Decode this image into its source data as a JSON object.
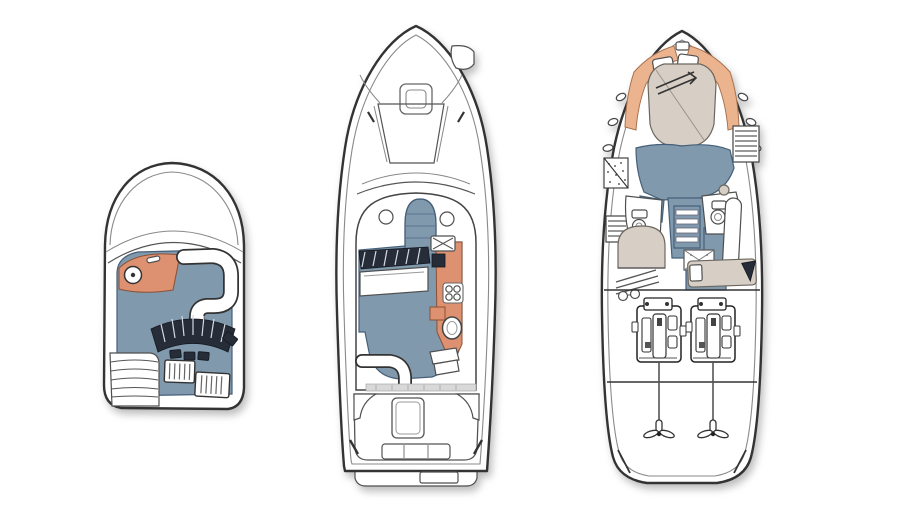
{
  "canvas": {
    "width": 900,
    "height": 506,
    "background": "#ffffff"
  },
  "colors": {
    "outline": "#333333",
    "outline_soft": "#8a8a8a",
    "deck_blue": "#8099ad",
    "deck_blue_dark": "#46607a",
    "helm_orange": "#dd9170",
    "helm_orange_light": "#ecb48e",
    "bed_beige": "#d7cfc5",
    "hatch_dark": "#262c38",
    "shadow": "rgba(70,70,70,0.35)"
  },
  "views": [
    {
      "id": "flybridge-plan",
      "position": "left",
      "features": [
        "helm-console",
        "steering-wheel",
        "wraparound-settee",
        "sunpad-seating",
        "deck-hatch-fore",
        "deck-hatch-aft",
        "ladder-steps"
      ]
    },
    {
      "id": "main-deck-plan",
      "position": "center",
      "features": [
        "anchor-locker",
        "foredeck-hatch",
        "windshield-frame",
        "porthole-port",
        "porthole-starboard",
        "companionway-steps",
        "salon-floor",
        "helm-dash",
        "side-berth",
        "l-settee",
        "galley-counter",
        "stove",
        "sink",
        "dinette-oval",
        "cockpit",
        "engine-hatch",
        "transom-seat",
        "swim-platform"
      ]
    },
    {
      "id": "lower-deck-plan",
      "position": "right",
      "features": [
        "v-berth",
        "pillows",
        "side-shelves",
        "hull-windows",
        "hanging-locker-port",
        "hanging-locker-starboard",
        "head-toilet-port",
        "head-toilet-starboard",
        "companionway-stairs",
        "shower-grate",
        "guest-berth",
        "mid-cabin-berth",
        "settee",
        "engine-room",
        "port-engine",
        "starboard-engine",
        "prop-shafts",
        "propellers"
      ]
    }
  ]
}
